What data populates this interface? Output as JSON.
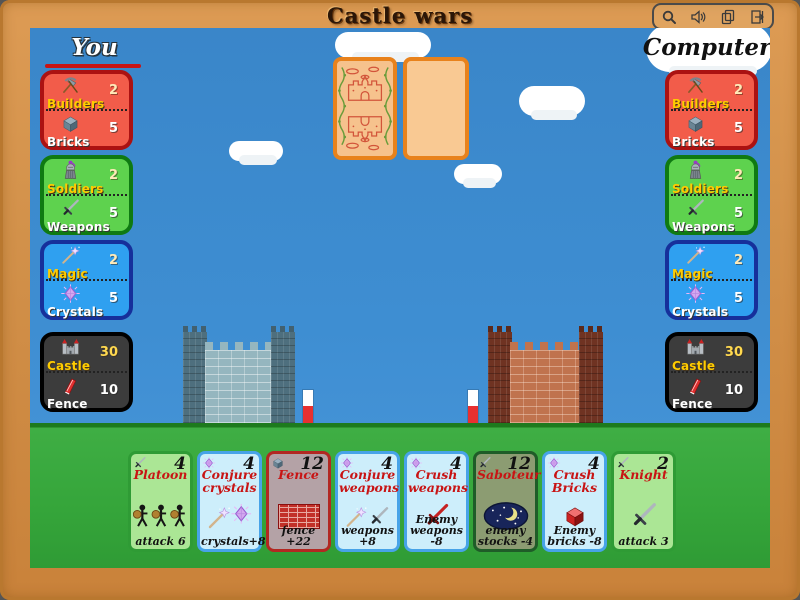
{
  "window": {
    "title": "Castle wars",
    "toolbar_icons": [
      "magnifier",
      "volume",
      "pages",
      "exit-door"
    ]
  },
  "players": {
    "you": {
      "label": "You",
      "panels": {
        "builders": {
          "top_label": "Builders",
          "top_value": 2,
          "bottom_label": "Bricks",
          "bottom_value": 5
        },
        "soldiers": {
          "top_label": "Soldiers",
          "top_value": 2,
          "bottom_label": "Weapons",
          "bottom_value": 5
        },
        "magic": {
          "top_label": "Magic",
          "top_value": 2,
          "bottom_label": "Crystals",
          "bottom_value": 5
        },
        "castle": {
          "top_label": "Castle",
          "top_value": 30,
          "bottom_label": "Fence",
          "bottom_value": 10
        }
      }
    },
    "computer": {
      "label": "Computer",
      "panels": {
        "builders": {
          "top_label": "Builders",
          "top_value": 2,
          "bottom_label": "Bricks",
          "bottom_value": 5
        },
        "soldiers": {
          "top_label": "Soldiers",
          "top_value": 2,
          "bottom_label": "Weapons",
          "bottom_value": 5
        },
        "magic": {
          "top_label": "Magic",
          "top_value": 2,
          "bottom_label": "Crystals",
          "bottom_value": 5
        },
        "castle": {
          "top_label": "Castle",
          "top_value": 30,
          "bottom_label": "Fence",
          "bottom_value": 10
        }
      }
    }
  },
  "hand": {
    "cards": [
      {
        "name": "Platoon",
        "cost": 4,
        "type": "attack",
        "corner_icon": "sword",
        "art": "three-warriors",
        "effect": "attack 6"
      },
      {
        "name": "Conjure crystals",
        "cost": 4,
        "type": "magic",
        "corner_icon": "crystal",
        "art": "wand-and-crystal",
        "effect": "crystals+8"
      },
      {
        "name": "Fence",
        "cost": 12,
        "type": "fence",
        "corner_icon": "brick",
        "art": "brick-wall",
        "effect": "fence +22"
      },
      {
        "name": "Conjure weapons",
        "cost": 4,
        "type": "magic",
        "corner_icon": "crystal",
        "art": "wand-and-sword",
        "effect": "weapons +8"
      },
      {
        "name": "Crush weapons",
        "cost": 4,
        "type": "magic",
        "corner_icon": "crystal",
        "art": "broken-red-sword",
        "effect": "Enemy weapons -8"
      },
      {
        "name": "Saboteur",
        "cost": 12,
        "type": "attack",
        "corner_icon": "sword",
        "art": "night-moon",
        "effect": "enemy stocks -4"
      },
      {
        "name": "Crush Bricks",
        "cost": 4,
        "type": "magic",
        "corner_icon": "crystal",
        "art": "red-brick",
        "effect": "Enemy bricks -8"
      },
      {
        "name": "Knight",
        "cost": 2,
        "type": "attack",
        "corner_icon": "sword",
        "art": "sword",
        "effect": "attack 3"
      }
    ]
  },
  "palette": {
    "frame": "#d2914a",
    "sky": "#3e8ed2",
    "grass": "#3aa83e",
    "panel_red": "#f25c4a",
    "panel_red_border": "#ab1212",
    "panel_green": "#5ed24e",
    "panel_green_border": "#0f7a12",
    "panel_blue": "#2fa0f0",
    "panel_blue_border": "#16309b",
    "panel_black": "#3c3c3c",
    "panel_black_border": "#000000",
    "card_attack_bg": "#abe695",
    "card_attack_border": "#2f9b35",
    "card_magic_bg": "#cdeefb",
    "card_magic_border": "#47a3e8",
    "card_fence_bg": "#b4a2a6",
    "card_fence_border": "#b22822",
    "card_saboteur_bg": "#8c9c72",
    "card_saboteur_border": "#1f5c28",
    "castle_left_wall": "#95b6bf",
    "castle_left_tower": "#4e6f7e",
    "castle_right_wall": "#c0734e",
    "castle_right_tower": "#6f3322",
    "title_red": "#c81414",
    "label_yellow": "#ffcc00"
  }
}
